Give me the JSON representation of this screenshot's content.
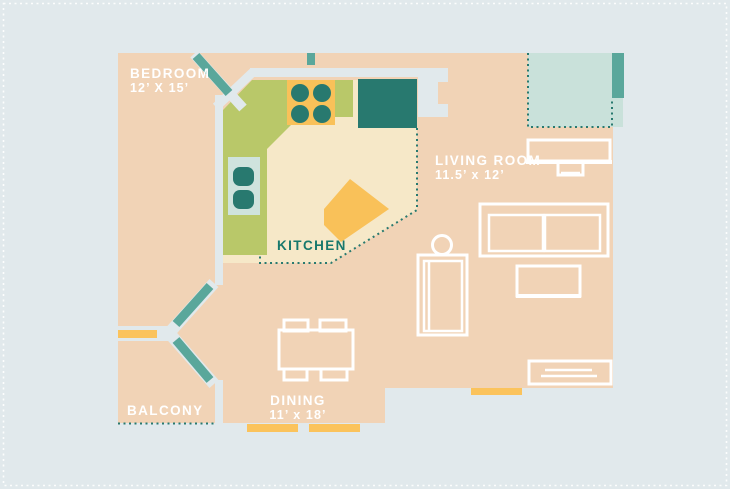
{
  "plan_title": "Apartment floor plan",
  "rooms": {
    "bedroom": {
      "name": "BEDROOM",
      "dims": "12’ X 15’"
    },
    "living_room": {
      "name": "LIVING ROOM",
      "dims": "11.5’ x 12’"
    },
    "kitchen": {
      "name": "KITCHEN"
    },
    "dining": {
      "name": "DINING",
      "dims": "11’ x 18’"
    },
    "balcony": {
      "name": "BALCONY"
    }
  },
  "colors": {
    "background": "#e1e9ec",
    "floor": "#f1d3b6",
    "kitchen_floor": "#f6e8c8",
    "counter_green": "#b9c869",
    "accent_yellow": "#f9c159",
    "window_yellow": "#fbc35c",
    "dark_teal": "#28796f",
    "door_teal": "#5aa79b",
    "terrace_mint": "#c9e1da",
    "outline_white": "#ffffff",
    "label_white": "#ffffff",
    "kitchen_label": "#17786c"
  }
}
